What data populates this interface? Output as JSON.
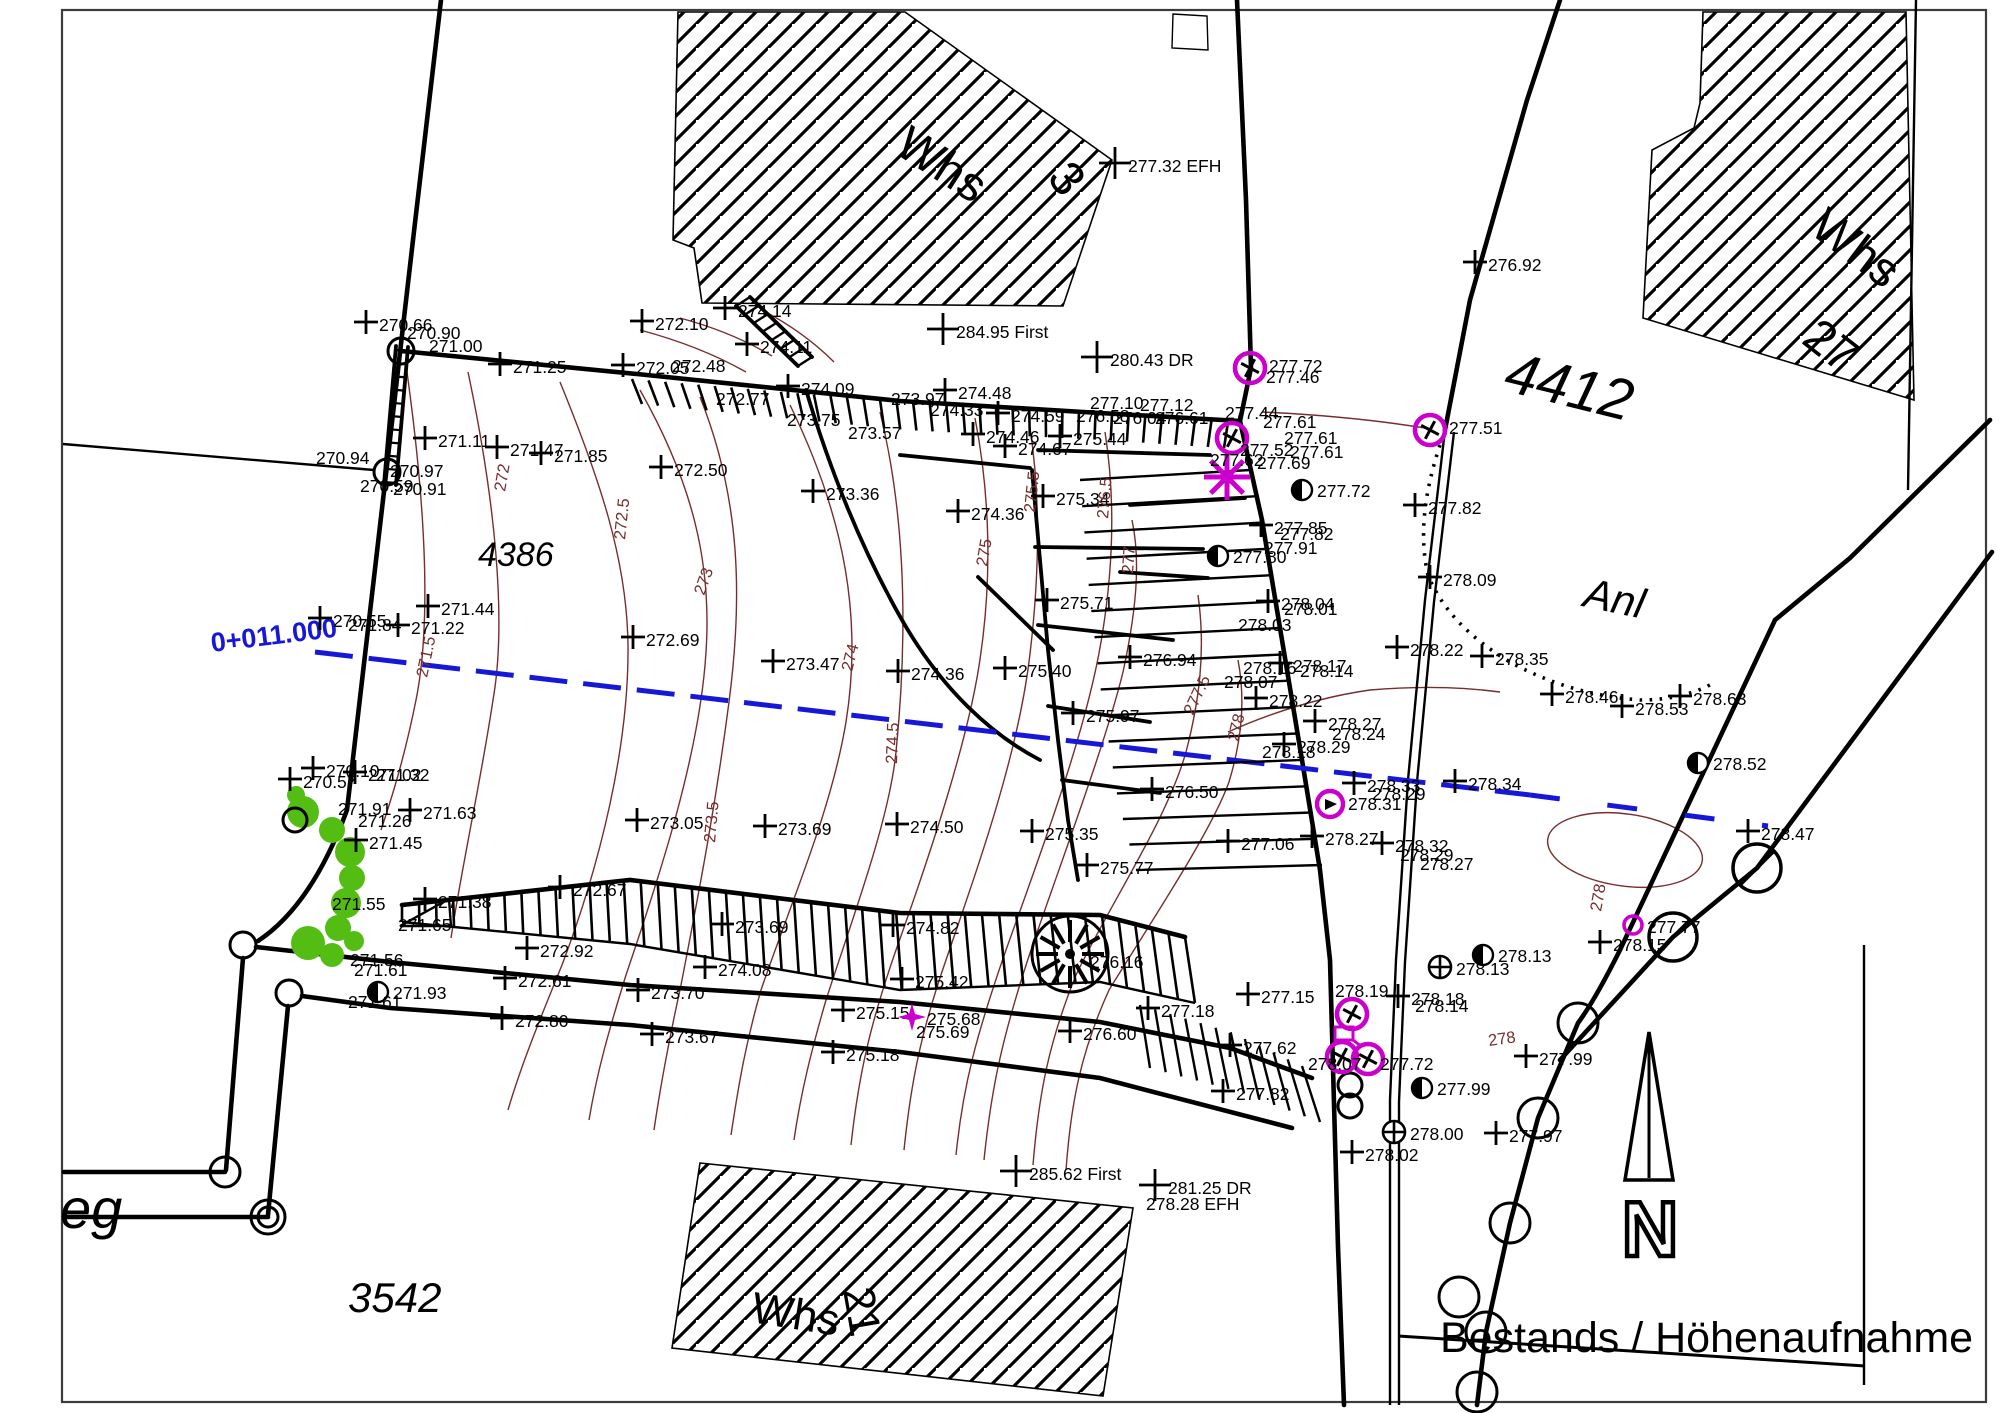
{
  "meta": {
    "title": "Bestands / Höhenaufnahme",
    "north_label": "N",
    "station_label": "0+011.000"
  },
  "colors": {
    "ink": "#000000",
    "contour": "#772d2d",
    "magenta": "#cc00cc",
    "blue": "#1717d8",
    "green": "#53bd13",
    "frame": "#3c3c3c"
  },
  "area_labels": [
    {
      "t": "Whs",
      "x": 893,
      "y": 152,
      "r": 33,
      "size": 48,
      "i": 0
    },
    {
      "t": "3",
      "x": 1046,
      "y": 178,
      "r": 52,
      "size": 48,
      "i": 0
    },
    {
      "t": "Whs",
      "x": 1808,
      "y": 232,
      "r": 37,
      "size": 48,
      "i": 0
    },
    {
      "t": "27",
      "x": 1800,
      "y": 342,
      "r": 38,
      "size": 48,
      "i": 0
    },
    {
      "t": "Whs",
      "x": 750,
      "y": 1322,
      "r": 9,
      "size": 44,
      "i": 0
    },
    {
      "t": "21",
      "x": 843,
      "y": 1290,
      "r": 80,
      "size": 44,
      "i": 0
    },
    {
      "t": "4386",
      "x": 478,
      "y": 566,
      "r": 0,
      "size": 34,
      "i": 1
    },
    {
      "t": "3542",
      "x": 348,
      "y": 1312,
      "r": 0,
      "size": 42,
      "i": 1
    },
    {
      "t": "4412",
      "x": 1502,
      "y": 390,
      "r": 14,
      "size": 58,
      "i": 1
    },
    {
      "t": "Anl",
      "x": 1582,
      "y": 606,
      "r": 12,
      "size": 42,
      "i": 1
    },
    {
      "t": "eg",
      "x": 60,
      "y": 1228,
      "r": 0,
      "size": 56,
      "i": 1
    }
  ],
  "contour_labels": [
    {
      "v": "271.5",
      "x": 427,
      "y": 678,
      "r": -78
    },
    {
      "v": "272",
      "x": 505,
      "y": 492,
      "r": -80
    },
    {
      "v": "272.5",
      "x": 625,
      "y": 540,
      "r": -84
    },
    {
      "v": "273",
      "x": 704,
      "y": 596,
      "r": -70
    },
    {
      "v": "273.5",
      "x": 715,
      "y": 843,
      "r": -85
    },
    {
      "v": "274",
      "x": 852,
      "y": 672,
      "r": -76
    },
    {
      "v": "274.5",
      "x": 897,
      "y": 764,
      "r": -88
    },
    {
      "v": "275",
      "x": 987,
      "y": 567,
      "r": -80
    },
    {
      "v": "275.5",
      "x": 1035,
      "y": 513,
      "r": -84
    },
    {
      "v": "276.5",
      "x": 1108,
      "y": 519,
      "r": -85
    },
    {
      "v": "277",
      "x": 1133,
      "y": 574,
      "r": -86
    },
    {
      "v": "277.5",
      "x": 1193,
      "y": 716,
      "r": -65
    },
    {
      "v": "278",
      "x": 1238,
      "y": 742,
      "r": -76
    },
    {
      "v": "278",
      "x": 1489,
      "y": 1046,
      "r": -8
    },
    {
      "v": "278",
      "x": 1601,
      "y": 912,
      "r": -80
    }
  ],
  "points": [
    {
      "x": 366,
      "y": 322,
      "v": "270.66"
    },
    {
      "x": 407,
      "y": 339,
      "v": "270.90",
      "s": "n"
    },
    {
      "x": 429,
      "y": 352,
      "v": "271.00",
      "s": "n"
    },
    {
      "x": 500,
      "y": 364,
      "v": "271.25"
    },
    {
      "x": 425,
      "y": 438,
      "v": "271.11"
    },
    {
      "x": 497,
      "y": 447,
      "v": "271.47"
    },
    {
      "x": 541,
      "y": 453,
      "v": "271.85"
    },
    {
      "x": 316,
      "y": 464,
      "v": "270.94",
      "s": "n"
    },
    {
      "x": 390,
      "y": 477,
      "v": "270.97",
      "s": "n"
    },
    {
      "x": 360,
      "y": 492,
      "v": "270.59",
      "s": "n"
    },
    {
      "x": 393,
      "y": 495,
      "v": "270.91",
      "s": "n"
    },
    {
      "x": 320,
      "y": 618,
      "v": "270.55"
    },
    {
      "x": 348,
      "y": 631,
      "v": "271.84",
      "s": "n"
    },
    {
      "x": 428,
      "y": 606,
      "v": "271.44"
    },
    {
      "x": 398,
      "y": 625,
      "v": "271.22"
    },
    {
      "x": 313,
      "y": 768,
      "v": "270.10"
    },
    {
      "x": 355,
      "y": 772,
      "v": "271.02"
    },
    {
      "x": 376,
      "y": 781,
      "v": "271.32",
      "s": "n"
    },
    {
      "x": 290,
      "y": 779,
      "v": "270.57"
    },
    {
      "x": 338,
      "y": 815,
      "v": "271.91",
      "s": "n"
    },
    {
      "x": 358,
      "y": 827,
      "v": "271.26",
      "s": "n"
    },
    {
      "x": 410,
      "y": 810,
      "v": "271.63"
    },
    {
      "x": 356,
      "y": 840,
      "v": "271.45"
    },
    {
      "x": 332,
      "y": 910,
      "v": "271.55",
      "s": "n"
    },
    {
      "x": 425,
      "y": 899,
      "v": "271.38"
    },
    {
      "x": 398,
      "y": 931,
      "v": "271.65",
      "s": "n"
    },
    {
      "x": 560,
      "y": 887,
      "v": "272.67"
    },
    {
      "x": 527,
      "y": 948,
      "v": "272.92"
    },
    {
      "x": 350,
      "y": 966,
      "v": "271.56",
      "s": "n"
    },
    {
      "x": 354,
      "y": 976,
      "v": "271.61",
      "s": "n"
    },
    {
      "x": 378,
      "y": 992,
      "v": "271.93",
      "s": "h"
    },
    {
      "x": 348,
      "y": 1008,
      "v": "271.61",
      "s": "n"
    },
    {
      "x": 505,
      "y": 978,
      "v": "272.61"
    },
    {
      "x": 502,
      "y": 1018,
      "v": "272.80"
    },
    {
      "x": 638,
      "y": 990,
      "v": "273.70"
    },
    {
      "x": 652,
      "y": 1034,
      "v": "273.67"
    },
    {
      "x": 722,
      "y": 924,
      "v": "273.69"
    },
    {
      "x": 705,
      "y": 967,
      "v": "274.08"
    },
    {
      "x": 843,
      "y": 1010,
      "v": "275.15"
    },
    {
      "x": 833,
      "y": 1052,
      "v": "275.18"
    },
    {
      "x": 893,
      "y": 925,
      "v": "274.82"
    },
    {
      "x": 902,
      "y": 979,
      "v": "275.42"
    },
    {
      "x": 912,
      "y": 1017,
      "v": "275.68",
      "s": "star"
    },
    {
      "x": 916,
      "y": 1038,
      "v": "275.69",
      "s": "n"
    },
    {
      "x": 1090,
      "y": 968,
      "v": "276.16",
      "s": "n"
    },
    {
      "x": 1070,
      "y": 1031,
      "v": "276.60"
    },
    {
      "x": 1148,
      "y": 1008,
      "v": "277.18"
    },
    {
      "x": 1248,
      "y": 994,
      "v": "277.15"
    },
    {
      "x": 1230,
      "y": 1045,
      "v": "277.62"
    },
    {
      "x": 1223,
      "y": 1091,
      "v": "277.82"
    },
    {
      "x": 1016,
      "y": 1171,
      "v": "285.62 First"
    },
    {
      "x": 1155,
      "y": 1185,
      "v": "281.25 DR"
    },
    {
      "x": 1146,
      "y": 1210,
      "v": "278.28 EFH",
      "s": "n"
    },
    {
      "x": 1115,
      "y": 163,
      "v": "277.32 EFH"
    },
    {
      "x": 943,
      "y": 329,
      "v": "284.95 First"
    },
    {
      "x": 1097,
      "y": 357,
      "v": "280.43 DR"
    },
    {
      "x": 1475,
      "y": 262,
      "v": "276.92"
    },
    {
      "x": 725,
      "y": 308,
      "v": "274.14"
    },
    {
      "x": 642,
      "y": 321,
      "v": "272.10"
    },
    {
      "x": 747,
      "y": 344,
      "v": "274.11"
    },
    {
      "x": 623,
      "y": 365,
      "v": "272.05"
    },
    {
      "x": 672,
      "y": 372,
      "v": "272.48",
      "s": "n"
    },
    {
      "x": 716,
      "y": 405,
      "v": "272.77",
      "s": "n"
    },
    {
      "x": 788,
      "y": 386,
      "v": "274.09"
    },
    {
      "x": 787,
      "y": 426,
      "v": "273.75",
      "s": "n"
    },
    {
      "x": 848,
      "y": 439,
      "v": "273.57",
      "s": "n"
    },
    {
      "x": 891,
      "y": 405,
      "v": "273.97",
      "s": "n"
    },
    {
      "x": 930,
      "y": 416,
      "v": "274.33",
      "s": "n"
    },
    {
      "x": 945,
      "y": 390,
      "v": "274.48"
    },
    {
      "x": 998,
      "y": 413,
      "v": "274.59"
    },
    {
      "x": 973,
      "y": 434,
      "v": "274.46"
    },
    {
      "x": 1005,
      "y": 446,
      "v": "274.67"
    },
    {
      "x": 1060,
      "y": 436,
      "v": "275.44"
    },
    {
      "x": 1090,
      "y": 409,
      "v": "277.10",
      "s": "n"
    },
    {
      "x": 1140,
      "y": 411,
      "v": "277.12",
      "s": "n"
    },
    {
      "x": 1076,
      "y": 422,
      "v": "276.58",
      "s": "n"
    },
    {
      "x": 1113,
      "y": 424,
      "v": "276.04",
      "s": "n"
    },
    {
      "x": 1155,
      "y": 424,
      "v": "276.61",
      "s": "n"
    },
    {
      "x": 661,
      "y": 467,
      "v": "272.50"
    },
    {
      "x": 813,
      "y": 491,
      "v": "273.36"
    },
    {
      "x": 633,
      "y": 637,
      "v": "272.69"
    },
    {
      "x": 773,
      "y": 661,
      "v": "273.47"
    },
    {
      "x": 898,
      "y": 671,
      "v": "274.36"
    },
    {
      "x": 1005,
      "y": 668,
      "v": "275.40"
    },
    {
      "x": 958,
      "y": 511,
      "v": "274.36"
    },
    {
      "x": 1043,
      "y": 496,
      "v": "275.34"
    },
    {
      "x": 1047,
      "y": 600,
      "v": "275.71"
    },
    {
      "x": 637,
      "y": 820,
      "v": "273.05"
    },
    {
      "x": 765,
      "y": 826,
      "v": "273.69"
    },
    {
      "x": 897,
      "y": 824,
      "v": "274.50"
    },
    {
      "x": 1032,
      "y": 831,
      "v": "275.35"
    },
    {
      "x": 1087,
      "y": 865,
      "v": "275.77"
    },
    {
      "x": 1073,
      "y": 713,
      "v": "275.97"
    },
    {
      "x": 1152,
      "y": 789,
      "v": "276.50"
    },
    {
      "x": 1130,
      "y": 657,
      "v": "276.94"
    },
    {
      "x": 1228,
      "y": 841,
      "v": "277.06"
    },
    {
      "x": 1250,
      "y": 368,
      "v": "277.72",
      "s": "mc"
    },
    {
      "x": 1266,
      "y": 383,
      "v": "277.46",
      "s": "n"
    },
    {
      "x": 1232,
      "y": 438,
      "v": "",
      "s": "mc"
    },
    {
      "x": 1225,
      "y": 419,
      "v": "277.44",
      "s": "n"
    },
    {
      "x": 1263,
      "y": 428,
      "v": "277.61",
      "s": "n"
    },
    {
      "x": 1240,
      "y": 456,
      "v": "277.52",
      "s": "n"
    },
    {
      "x": 1257,
      "y": 469,
      "v": "277.69",
      "s": "n"
    },
    {
      "x": 1284,
      "y": 444,
      "v": "277.61",
      "s": "n"
    },
    {
      "x": 1290,
      "y": 458,
      "v": "277.61",
      "s": "n"
    },
    {
      "x": 1227,
      "y": 477,
      "v": "",
      "s": "ast"
    },
    {
      "x": 1210,
      "y": 466,
      "v": "277.62",
      "s": "n"
    },
    {
      "x": 1430,
      "y": 430,
      "v": "277.51",
      "s": "mc"
    },
    {
      "x": 1302,
      "y": 490,
      "v": "277.72",
      "s": "h"
    },
    {
      "x": 1261,
      "y": 525,
      "v": "277.85"
    },
    {
      "x": 1280,
      "y": 540,
      "v": "277.82",
      "s": "n"
    },
    {
      "x": 1218,
      "y": 556,
      "v": "277.80",
      "s": "h"
    },
    {
      "x": 1264,
      "y": 554,
      "v": "277.91",
      "s": "n"
    },
    {
      "x": 1415,
      "y": 505,
      "v": "277.82"
    },
    {
      "x": 1430,
      "y": 577,
      "v": "278.09"
    },
    {
      "x": 1268,
      "y": 601,
      "v": "278.04"
    },
    {
      "x": 1284,
      "y": 615,
      "v": "278.01",
      "s": "n"
    },
    {
      "x": 1238,
      "y": 631,
      "v": "278.03",
      "s": "n"
    },
    {
      "x": 1397,
      "y": 647,
      "v": "278.22"
    },
    {
      "x": 1482,
      "y": 656,
      "v": "278.35"
    },
    {
      "x": 1280,
      "y": 663,
      "v": "278.17"
    },
    {
      "x": 1300,
      "y": 677,
      "v": "278.14",
      "s": "n"
    },
    {
      "x": 1243,
      "y": 674,
      "v": "278.16",
      "s": "n"
    },
    {
      "x": 1224,
      "y": 688,
      "v": "278.07",
      "s": "n"
    },
    {
      "x": 1256,
      "y": 698,
      "v": "278.22"
    },
    {
      "x": 1315,
      "y": 721,
      "v": "278.27"
    },
    {
      "x": 1332,
      "y": 740,
      "v": "278.24",
      "s": "n"
    },
    {
      "x": 1284,
      "y": 744,
      "v": "278.29"
    },
    {
      "x": 1262,
      "y": 758,
      "v": "278.18",
      "s": "n"
    },
    {
      "x": 1354,
      "y": 783,
      "v": "278.33"
    },
    {
      "x": 1372,
      "y": 800,
      "v": "278.29",
      "s": "n"
    },
    {
      "x": 1455,
      "y": 781,
      "v": "278.34"
    },
    {
      "x": 1330,
      "y": 804,
      "v": "278.31",
      "s": "mr"
    },
    {
      "x": 1312,
      "y": 836,
      "v": "278.27"
    },
    {
      "x": 1382,
      "y": 843,
      "v": "278.32"
    },
    {
      "x": 1400,
      "y": 861,
      "v": "278.29",
      "s": "n"
    },
    {
      "x": 1420,
      "y": 870,
      "v": "278.27",
      "s": "n"
    },
    {
      "x": 1552,
      "y": 694,
      "v": "278.46"
    },
    {
      "x": 1622,
      "y": 706,
      "v": "278.53"
    },
    {
      "x": 1680,
      "y": 696,
      "v": "278.63"
    },
    {
      "x": 1698,
      "y": 763,
      "v": "278.52",
      "s": "h"
    },
    {
      "x": 1748,
      "y": 831,
      "v": "278.47"
    },
    {
      "x": 1633,
      "y": 925,
      "v": "277.77",
      "s": "ms"
    },
    {
      "x": 1600,
      "y": 942,
      "v": "278.15"
    },
    {
      "x": 1440,
      "y": 967,
      "v": "278.13",
      "s": "op"
    },
    {
      "x": 1483,
      "y": 955,
      "v": "278.13",
      "s": "h"
    },
    {
      "x": 1398,
      "y": 996,
      "v": "278.18"
    },
    {
      "x": 1415,
      "y": 1012,
      "v": "278.14",
      "s": "n"
    },
    {
      "x": 1335,
      "y": 997,
      "v": "278.19",
      "s": "n"
    },
    {
      "x": 1352,
      "y": 1014,
      "v": "",
      "s": "mc"
    },
    {
      "x": 1344,
      "y": 1034,
      "v": "",
      "s": "flag"
    },
    {
      "x": 1342,
      "y": 1057,
      "v": "",
      "s": "mc"
    },
    {
      "x": 1368,
      "y": 1059,
      "v": "",
      "s": "mc"
    },
    {
      "x": 1308,
      "y": 1070,
      "v": "278.07",
      "s": "n"
    },
    {
      "x": 1380,
      "y": 1070,
      "v": "277.72",
      "s": "n"
    },
    {
      "x": 1352,
      "y": 1152,
      "v": "278.02"
    },
    {
      "x": 1526,
      "y": 1056,
      "v": "277.99"
    },
    {
      "x": 1422,
      "y": 1088,
      "v": "277.99",
      "s": "h"
    },
    {
      "x": 1394,
      "y": 1132,
      "v": "278.00",
      "s": "op"
    },
    {
      "x": 1496,
      "y": 1133,
      "v": "277.97"
    }
  ]
}
